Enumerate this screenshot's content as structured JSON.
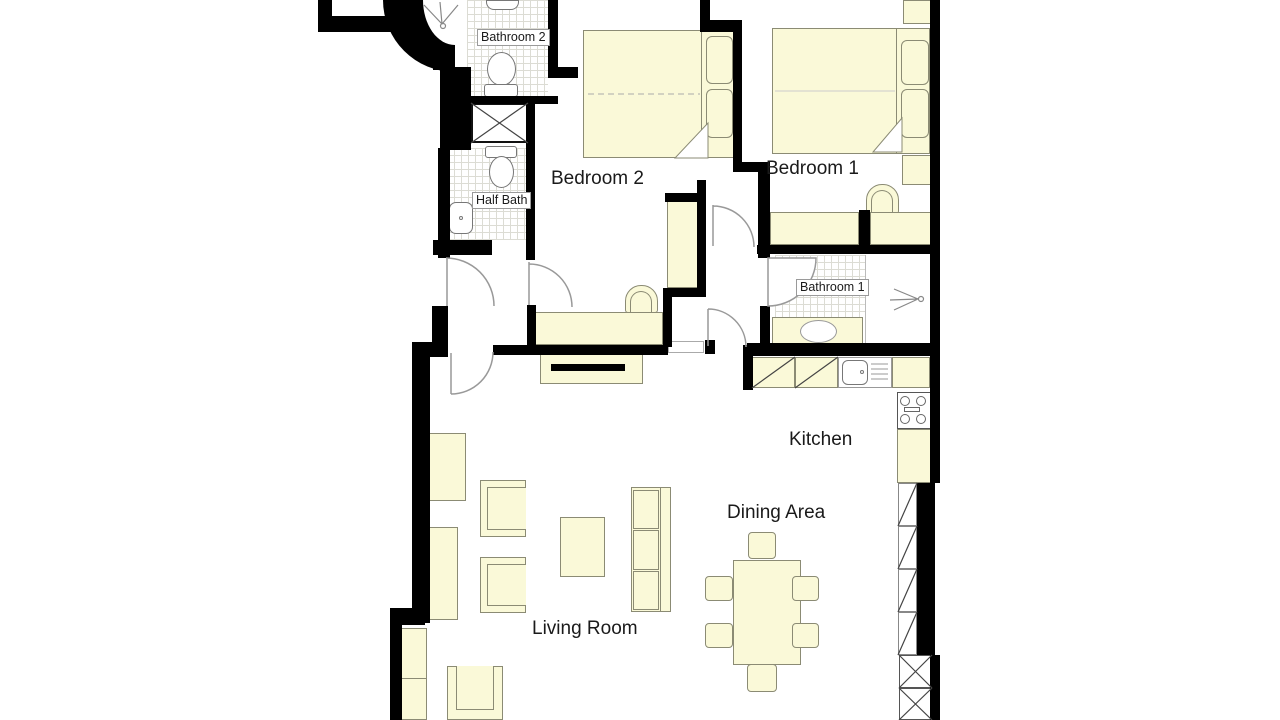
{
  "plan": {
    "type": "apartment-floor-plan",
    "rooms": {
      "bedroom1": {
        "label": "Bedroom 1"
      },
      "bedroom2": {
        "label": "Bedroom 2"
      },
      "bathroom1": {
        "label": "Bathroom 1"
      },
      "bathroom2": {
        "label": "Bathroom 2"
      },
      "half_bath": {
        "label": "Half Bath"
      },
      "kitchen": {
        "label": "Kitchen"
      },
      "dining_area": {
        "label": "Dining Area"
      },
      "living_room": {
        "label": "Living Room"
      }
    },
    "colors": {
      "background": "#FFFFFF",
      "wall": "#000000",
      "furniture_fill": "#FAF9D8",
      "furniture_outline": "#8B8B74",
      "door_swing": "#999999",
      "tile_grid": "#DCDCD4"
    }
  }
}
